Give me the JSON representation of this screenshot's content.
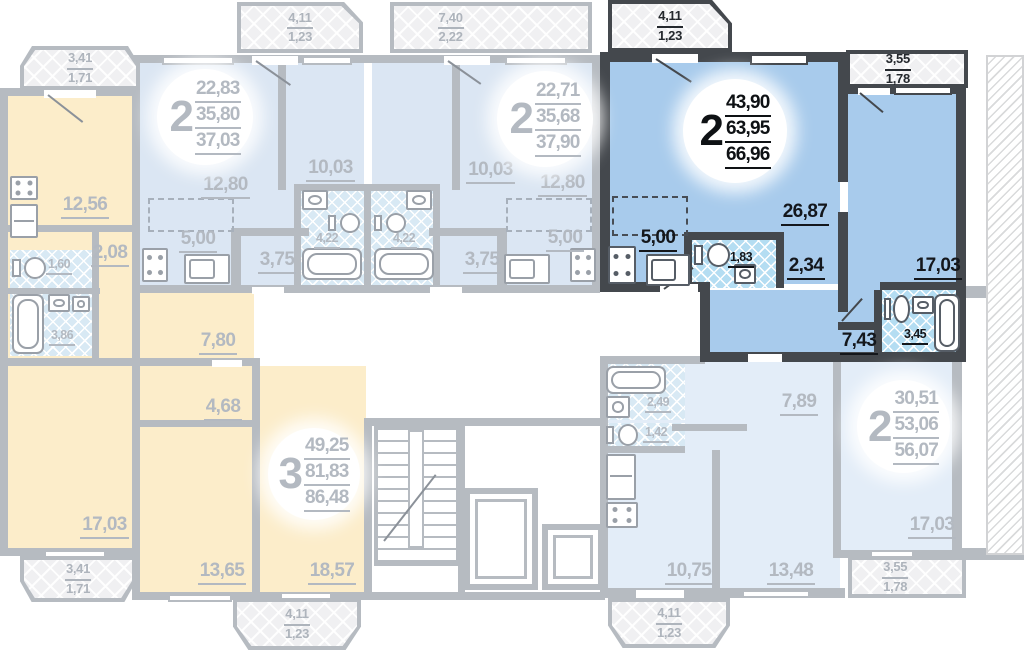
{
  "plan": {
    "apartments": {
      "top_left": {
        "rooms": "2",
        "area_living": "22,83",
        "area_apartment": "35,80",
        "area_total": "37,03",
        "room_living": "12,80",
        "room_bedroom": "10,03",
        "kitchen": "5,00",
        "hall": "3,75",
        "bath": "4,22"
      },
      "top_center": {
        "rooms": "2",
        "area_living": "22,71",
        "area_apartment": "35,68",
        "area_total": "37,90",
        "room_living": "12,80",
        "room_bedroom": "10,03",
        "kitchen": "5,00",
        "hall": "3,75",
        "bath": "4,22"
      },
      "highlighted": {
        "rooms": "2",
        "area_living": "43,90",
        "area_apartment": "63,95",
        "area_total": "66,96",
        "room_living": "26,87",
        "kitchen": "5,00",
        "wc": "1,83",
        "hall_inner": "2,34",
        "room_bedroom": "17,03",
        "hall": "7,43",
        "bath": "3,45"
      },
      "bottom_left": {
        "rooms": "3",
        "area_living": "49,25",
        "area_apartment": "81,83",
        "area_total": "86,48",
        "kitchen": "12,56",
        "hall_a": "2,08",
        "wc": "1,60",
        "bath": "3,86",
        "hall_b": "7,80",
        "hall_c": "4,68",
        "room_a": "17,03",
        "room_b": "13,65",
        "room_c": "18,57"
      },
      "bottom_right": {
        "rooms": "2",
        "area_living": "30,51",
        "area_apartment": "53,06",
        "area_total": "56,07",
        "hall": "7,89",
        "bath": "2,49",
        "wc": "1,42",
        "kitchen": "10,75",
        "room_a": "13,48",
        "room_b": "17,03"
      }
    },
    "balconies": {
      "tl": {
        "l1": "3,41",
        "l2": "1,71"
      },
      "ta": {
        "l1": "4,11",
        "l2": "1,23"
      },
      "tb": {
        "l1": "7,40",
        "l2": "2,22"
      },
      "tc": {
        "l1": "4,11",
        "l2": "1,23"
      },
      "tr": {
        "l1": "3,55",
        "l2": "1,78"
      },
      "bl": {
        "l1": "3,41",
        "l2": "1,71"
      },
      "ba": {
        "l1": "4,11",
        "l2": "1,23"
      },
      "bb": {
        "l1": "4,11",
        "l2": "1,23"
      },
      "br": {
        "l1": "3,55",
        "l2": "1,78"
      }
    },
    "colors": {
      "highlight_fill": "#a8cbec",
      "muted_fill": "#dbe6f3",
      "warm_fill": "#fcedca",
      "wall": "#b6bbc1",
      "wall_dark": "#44484d",
      "text_muted": "#b3b9c1",
      "text_dark": "#14171c"
    }
  }
}
